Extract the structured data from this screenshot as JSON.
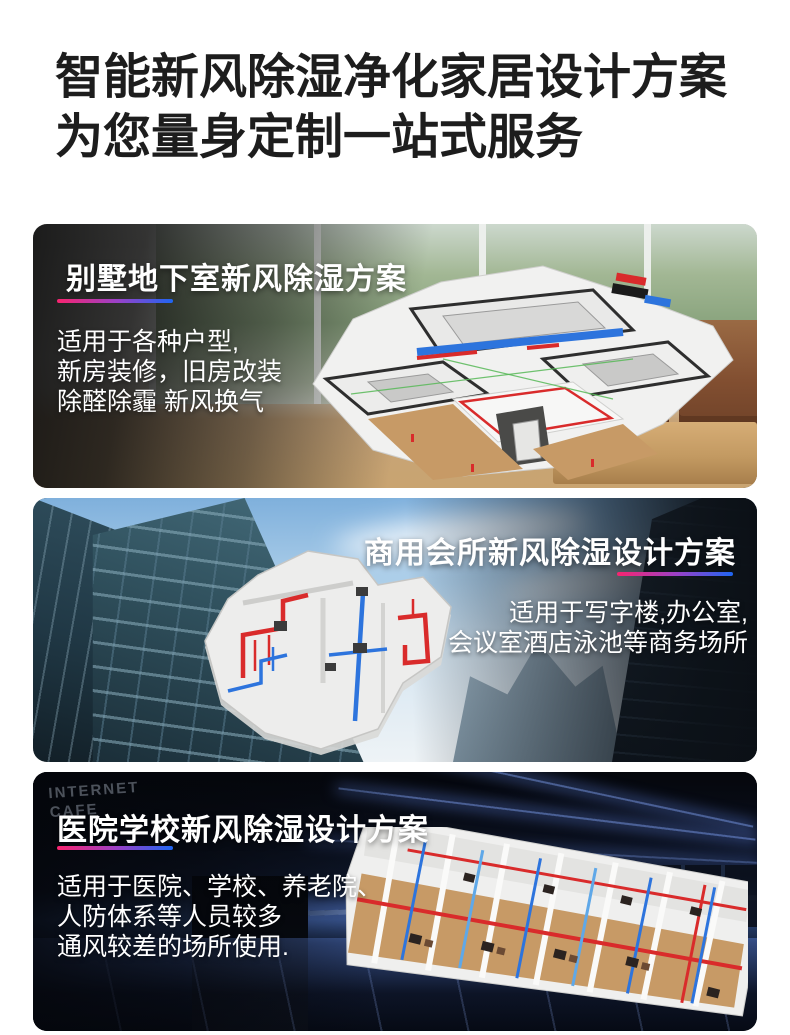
{
  "header": {
    "line1": "智能新风除湿净化家居设计方案",
    "line2": "为您量身定制一站式服务"
  },
  "colors": {
    "heading_text": "#1d1d1d",
    "card_text": "#ffffff",
    "underline_gradient_start": "#f8246f",
    "underline_gradient_mid": "#9a41c8",
    "underline_gradient_end": "#1f66f2",
    "duct_red": "#d92b2b",
    "duct_blue": "#2d74dd"
  },
  "cards": [
    {
      "title": "别墅地下室新风除湿方案",
      "lines": [
        "适用于各种户型,",
        "新房装修，旧房改装",
        "除醛除霾 新风换气"
      ]
    },
    {
      "title": "商用会所新风除湿设计方案",
      "lines": [
        "适用于写字楼,办公室,",
        "会议室酒店泳池等商务场所"
      ]
    },
    {
      "title": "医院学校新风除湿设计方案",
      "lines": [
        "适用于医院、学校、养老院、",
        "人防体系等人员较多",
        "通风较差的场所使用."
      ],
      "background_label": "INTERNET CAFE"
    }
  ]
}
